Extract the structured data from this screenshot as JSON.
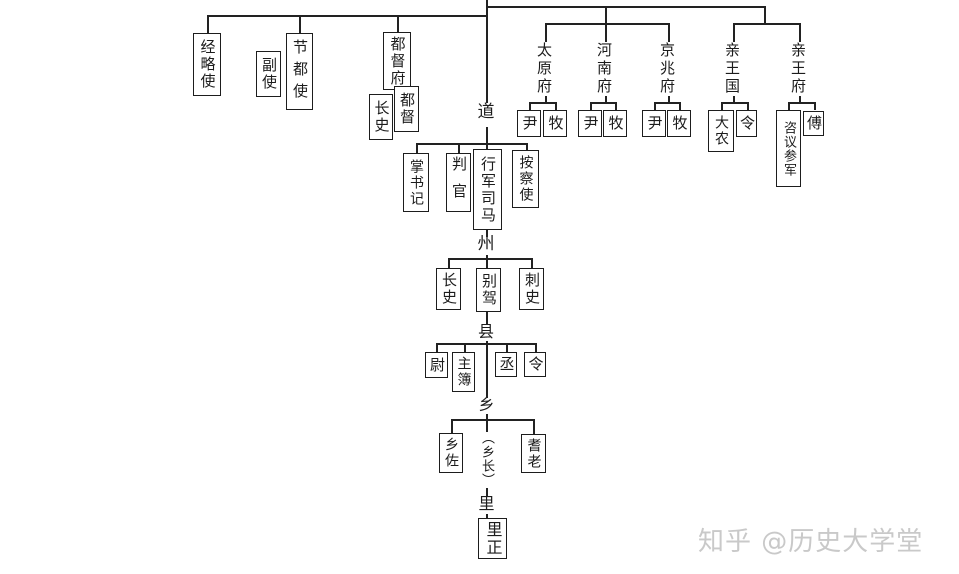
{
  "colors": {
    "ink": "#222222",
    "watermark": "#c9c9c9",
    "background": "#ffffff"
  },
  "watermark": "知乎 @历史大学堂",
  "levels": {
    "dao": "道",
    "zhou": "州",
    "xian": "县",
    "xiang": "乡",
    "xiang_head": "（乡长）",
    "li": "里"
  },
  "region_labels": {
    "taiyuanfu": "太原府",
    "henanfu": "河南府",
    "jingzhaofu": "京兆府",
    "qinwangguo": "亲王国",
    "qinwangfu": "亲王府"
  },
  "offices": {
    "jinglueshi": "经略使",
    "fushi": "副使",
    "jiedushi": "节都使",
    "dudufu": "都督府",
    "dudufu_zhangshi": "长史",
    "dudu": "都督",
    "zhangshuji": "掌书记",
    "panguan": "判官",
    "xingjunsima": "行军司马",
    "anchashi": "按察使",
    "zhou_zhangshi": "长史",
    "biejia": "别驾",
    "cishi": "刺史",
    "wei": "尉",
    "zhubu": "主簿",
    "cheng": "丞",
    "xianling": "令",
    "xiangzuo": "乡佐",
    "qilao": "耆老",
    "lizheng": "里正",
    "yin": "尹",
    "mu": "牧",
    "danong": "大农",
    "guoling": "令",
    "ziyicanjun": "咨议参军",
    "fu": "傅"
  }
}
